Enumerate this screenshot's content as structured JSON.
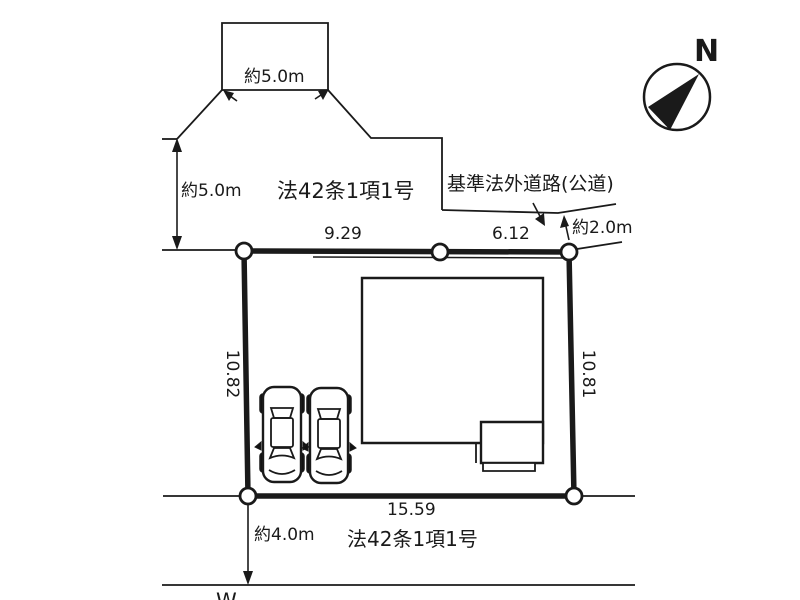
{
  "diagram": {
    "compass_label": "N",
    "upper_road": {
      "name": "法42条1項1号",
      "flag_width": "約5.0m",
      "side_width": "約5.0m"
    },
    "outside_road": {
      "name": "基準法外道路(公道)",
      "width": "約2.0m"
    },
    "bottom_road": {
      "name": "法42条1項1号",
      "width": "約4.0m"
    },
    "parcel_dims": {
      "top_left": "9.29",
      "top_right": "6.12",
      "left": "10.82",
      "right": "10.81",
      "bottom": "15.59"
    },
    "partial_text": "W"
  },
  "colors": {
    "line": "#1a1a1a",
    "background": "#ffffff"
  }
}
